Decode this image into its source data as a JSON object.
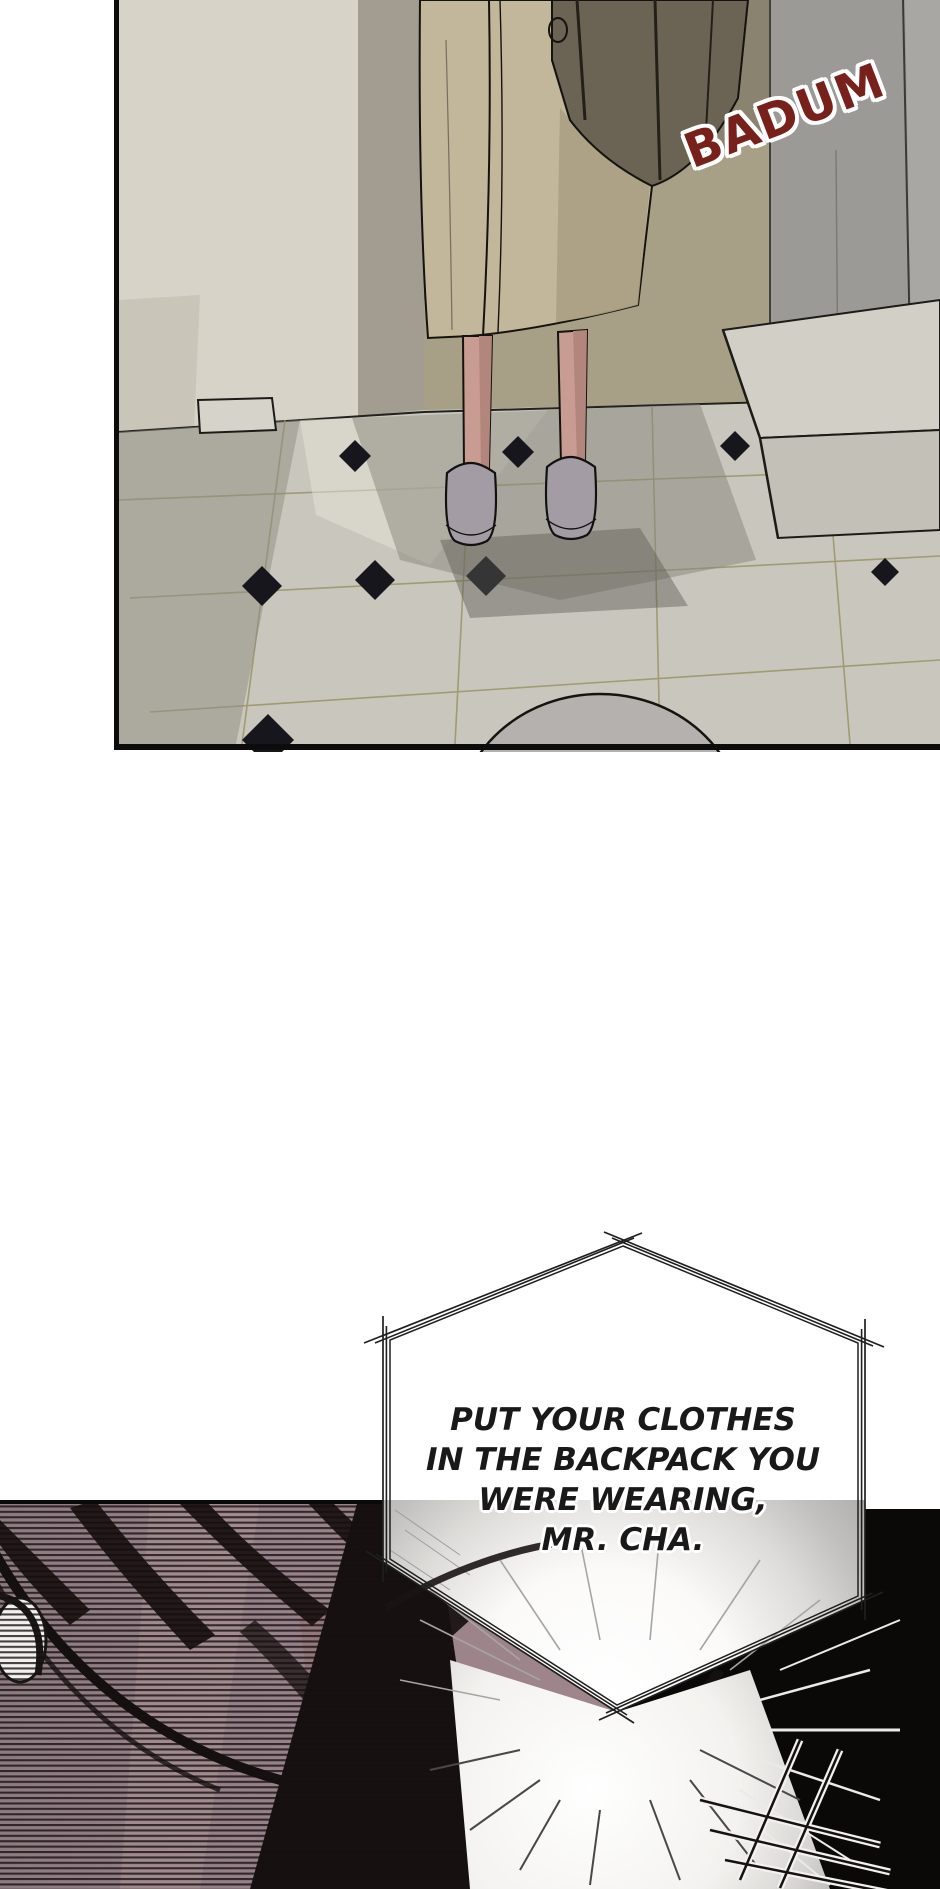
{
  "page": {
    "width": 940,
    "height": 1889,
    "background": "#ffffff",
    "kind": "manhwa-comic-page"
  },
  "panel_top": {
    "description": "Entryway scene viewed from above: person in a beige coat, bare legs and gray slippers standing on a marble tile floor with black diamond accents",
    "sfx": {
      "text": "BADUM",
      "color": "#78211b",
      "outline_color": "#ffffff",
      "rotation_deg": -21
    },
    "colors": {
      "wall_left_cream": "#d8d3c8",
      "wall_mid_olive": "#8a8370",
      "wall_right_gray": "#9c9a96",
      "coat_beige": "#c2b69b",
      "bag_dark": "#6b6455",
      "skin": "#c89b93",
      "slipper_gray": "#a49ca4",
      "floor_tile": "#c9c6bd",
      "grout_olive": "#9a9466",
      "diamond_accent": "#17161d",
      "panel_border": "#0c0c0c"
    }
  },
  "speech_bubble": {
    "shape": "irregular-hexagon-triple-outline",
    "fill": "#ffffff",
    "stroke": "#1f1f1f",
    "text_color": "#191919",
    "lines": [
      "PUT YOUR CLOTHES",
      "IN THE BACKPACK YOU",
      "WERE WEARING,",
      "MR. CHA."
    ]
  },
  "panel_bottom": {
    "description": "Dark close-up of the back of a head with earphone and wire over horizontal blind stripes; white light burst with radiating speed lines and scratch marks",
    "colors": {
      "base_black": "#0b0908",
      "mauve": "#97818a",
      "stripe": "#160e0e",
      "hair": "#221919",
      "dark_band": "#161110",
      "burst_center": "#ffffff",
      "burst_edge": "#b0aeac",
      "earbud": "#f2f1ef",
      "speed_line_dark": "#4a4846",
      "speed_line_white": "#eceae8"
    }
  }
}
